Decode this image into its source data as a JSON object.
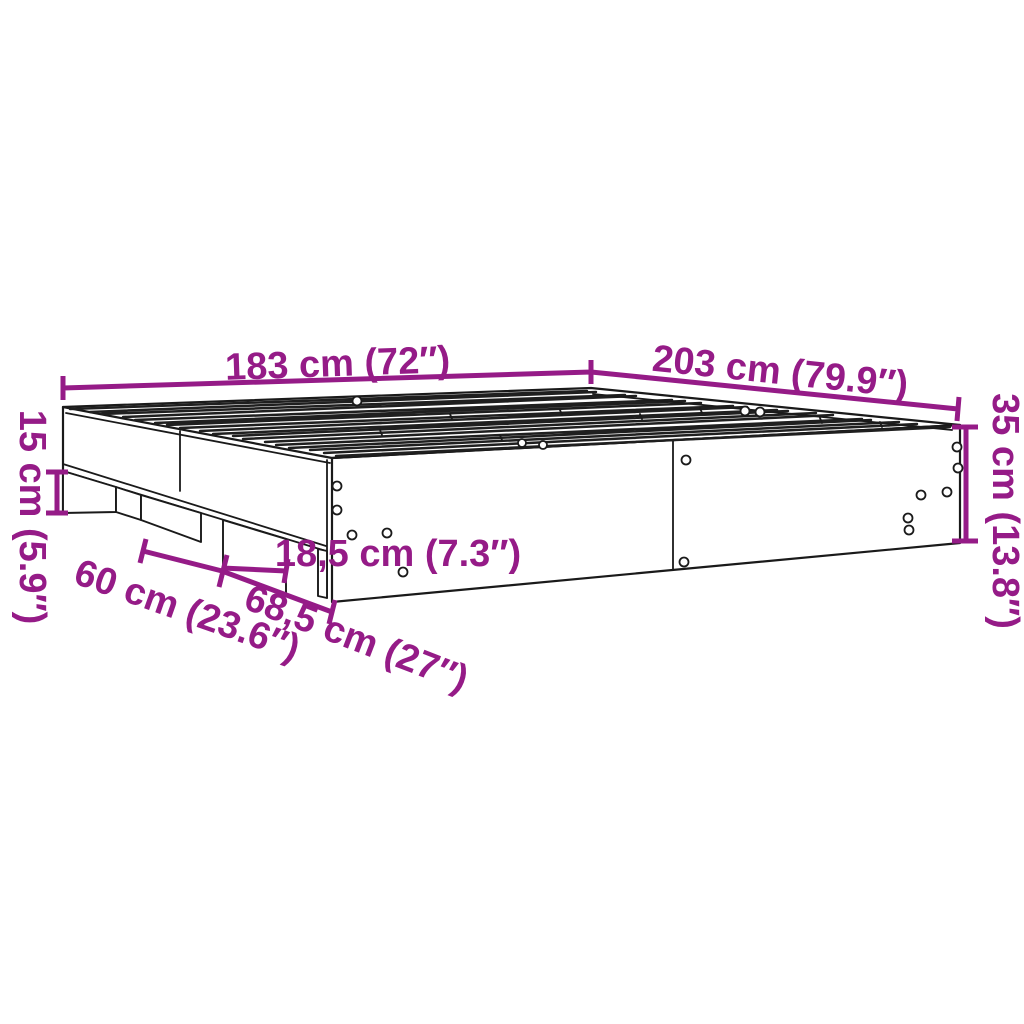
{
  "title": "Bed frame dimension diagram",
  "colors": {
    "accent": "#951B87",
    "line": "#1A1A1A",
    "background": "#FFFFFF"
  },
  "product": "bed-frame-with-slatted-base",
  "dimensions": {
    "width": "183 cm (72″)",
    "length": "203 cm (79.9″)",
    "height_total": "35 cm (13.8″)",
    "height_base": "15 cm (5.9″)",
    "support_width": "18,5 cm (7.3″)",
    "recess_left": "60 cm (23.6″)",
    "recess_right": "68,5 cm (27″)"
  }
}
